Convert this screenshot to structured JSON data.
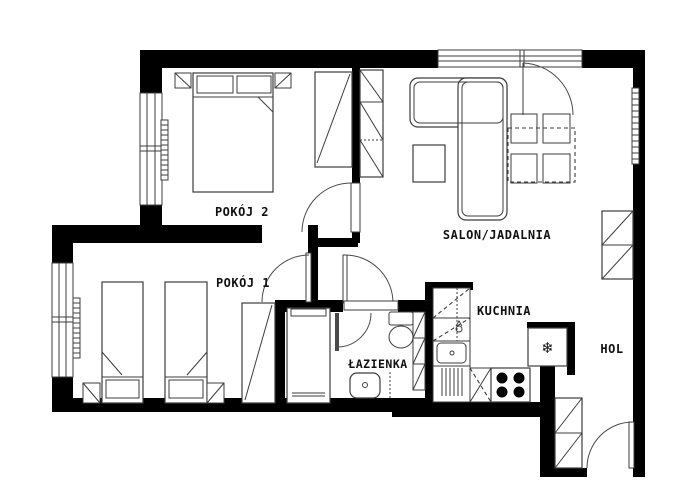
{
  "floorplan": {
    "background_color": "#ffffff",
    "wall_color": "#000000",
    "line_color": "#3d3d3d",
    "rooms": [
      {
        "id": "pokoj-2",
        "label": "POKÓJ 2"
      },
      {
        "id": "salon-jadalnia",
        "label": "SALON/JADALNIA"
      },
      {
        "id": "pokoj-1",
        "label": "POKÓJ 1"
      },
      {
        "id": "lazienka",
        "label": "ŁAZIENKA"
      },
      {
        "id": "kuchnia",
        "label": "KUCHNIA"
      },
      {
        "id": "hol",
        "label": "HOL"
      }
    ],
    "icons": {
      "fridge_snowflake": "❄"
    }
  }
}
